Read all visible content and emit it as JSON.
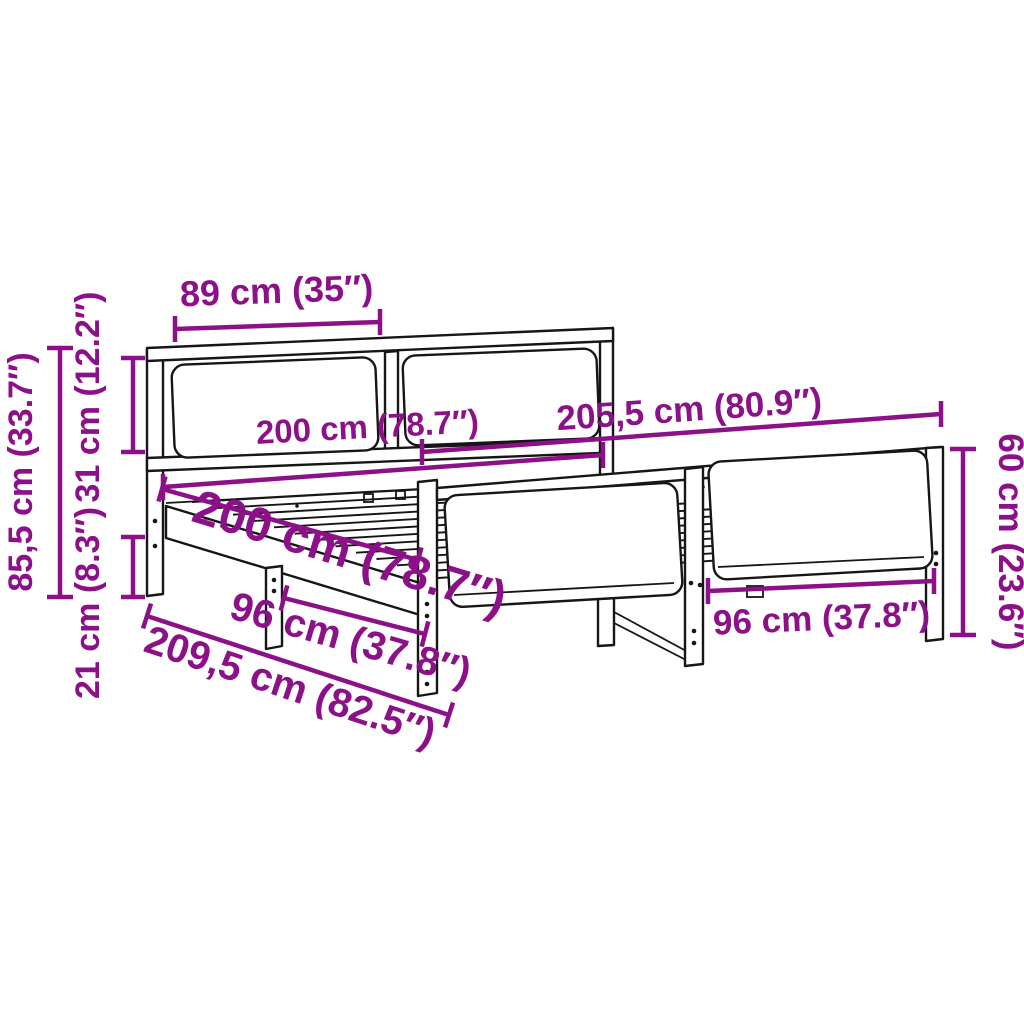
{
  "meta": {
    "title": "Bed frame dimension diagram",
    "type": "product-dimension-diagram",
    "subject": "bed frame with headboard, footboard and slatted base"
  },
  "colors": {
    "dimension": "#8C1088",
    "outline": "#161616",
    "background": "#ffffff"
  },
  "dimensions": {
    "headboard_panel_width": {
      "label": "89 cm (35″)"
    },
    "headboard_height": {
      "label": "85,5 cm (33.7″)"
    },
    "headboard_top_section_height": {
      "label": "31 cm (12.2″)"
    },
    "leg_height": {
      "label": "21 cm (8.3″)"
    },
    "bed_length_inner": {
      "label": "200 cm (78.7″)"
    },
    "total_length": {
      "label": "205,5 cm (80.9″)"
    },
    "footboard_height": {
      "label": "60 cm (23.6″)"
    },
    "bed_width_diagonal": {
      "label": "200 cm (78.7″)"
    },
    "leg_spacing_left": {
      "label": "96 cm (37.8″)"
    },
    "leg_spacing_right": {
      "label": "96 cm (37.8″)"
    },
    "total_width": {
      "label": "209,5 cm (82.5″)"
    }
  }
}
